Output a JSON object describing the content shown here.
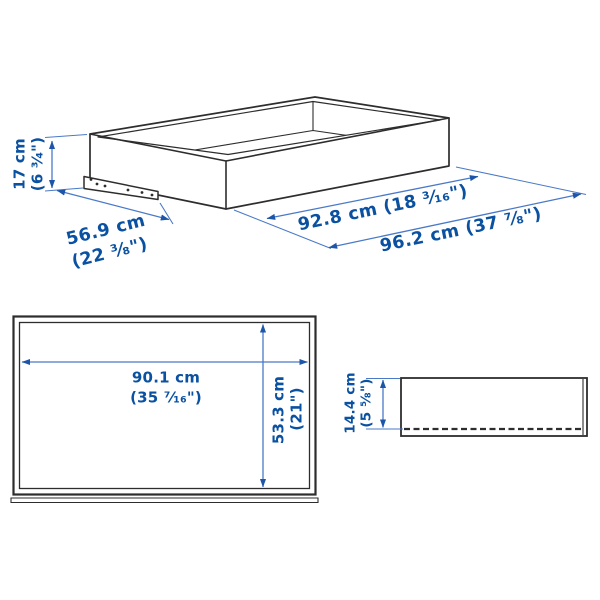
{
  "page": {
    "background": "#ffffff"
  },
  "colors": {
    "line_art": "#2d2d2d",
    "dimension_line": "#4a79c8",
    "arrowhead": "#1d55a8",
    "dimension_text": "#0a51a1"
  },
  "views": {
    "isometric": {
      "name": "drawer-3d-view",
      "dims": {
        "height_cm": "17 cm",
        "height_in": "(6 ³⁄₄\")",
        "depth_cm": "56.9 cm",
        "depth_in": "(22 ³⁄₈\")",
        "inner_width": "92.8 cm (18 ³⁄₁₆\")",
        "outer_width": "96.2 cm (37 ⁷⁄₈\")"
      }
    },
    "front": {
      "name": "drawer-front-view",
      "dims": {
        "inner_width_cm": "90.1 cm",
        "inner_width_in": "(35 ⁷⁄₁₆\")",
        "inner_height_cm": "53.3 cm",
        "inner_height_in": "(21\")"
      }
    },
    "side": {
      "name": "drawer-side-view",
      "dims": {
        "front_height_cm": "14.4 cm",
        "front_height_in": "(5 ⁵⁄₈\")"
      }
    }
  }
}
